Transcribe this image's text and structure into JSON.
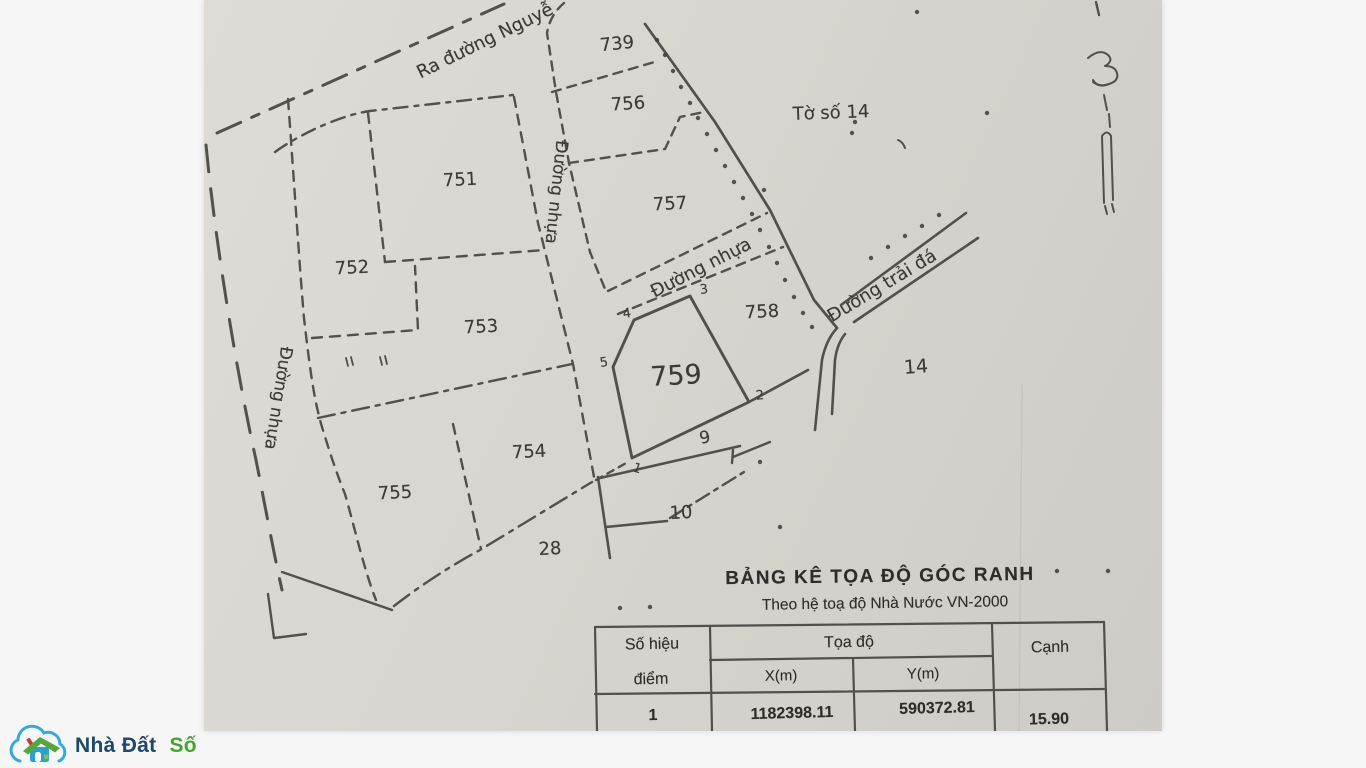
{
  "map": {
    "sheet_label": "Tờ số 14",
    "adjacent_sheet_number": "14",
    "roads": {
      "nguyen_exit": "Ra đường Nguyễ",
      "nhua_left": "Đường nhựa",
      "nhua_center": "Đường nhựa",
      "nhua_diagonal": "Đường nhựa",
      "trai_da": "Đường trải đá"
    },
    "parcels": {
      "p739": "739",
      "p751": "751",
      "p752": "752",
      "p753": "753",
      "p754": "754",
      "p755": "755",
      "p756": "756",
      "p757": "757",
      "p758": "758",
      "p759": "759"
    },
    "path_labels": {
      "l9": "9",
      "l10": "10",
      "l28": "28"
    },
    "points": {
      "p1": "1",
      "p2": "2",
      "p3": "3",
      "p4": "4",
      "p5": "5"
    }
  },
  "table": {
    "title": "BẢNG KÊ TỌA ĐỘ GÓC RANH",
    "subtitle": "Theo hệ toạ độ Nhà Nước VN-2000",
    "headers": {
      "point_no_line1": "Số hiệu",
      "point_no_line2": "điểm",
      "coords": "Tọa độ",
      "x": "X(m)",
      "y": "Y(m)",
      "edge": "Cạnh"
    },
    "rows": [
      {
        "no": "1",
        "x": "1182398.11",
        "y": "590372.81",
        "edge": "15.90"
      }
    ]
  },
  "brand": {
    "name_dark": "Nhà Đất",
    "name_green": "Số"
  }
}
